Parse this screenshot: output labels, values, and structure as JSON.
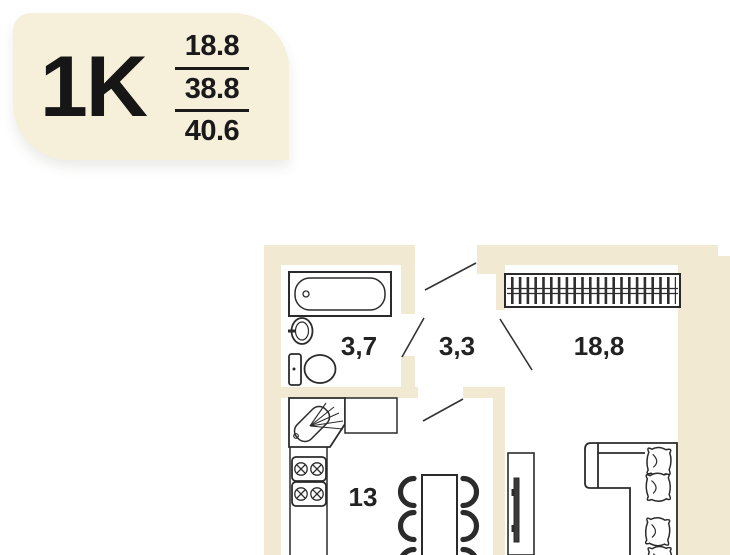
{
  "badge": {
    "type_label": "1K",
    "areas": {
      "living": "18.8",
      "apartment": "38.8",
      "total": "40.6"
    }
  },
  "floor_plan": {
    "room_labels": {
      "bathroom": "3,7",
      "hallway": "3,3",
      "living_room": "18,8",
      "kitchen": "13"
    },
    "fixture_names": [
      "bathtub",
      "wash-basin",
      "toilet",
      "corner-sink",
      "kitchen-counter",
      "stove",
      "wardrobe",
      "dining-table",
      "chair",
      "tv-stand",
      "corner-sofa",
      "sofa-pillow",
      "door-swing"
    ],
    "colors": {
      "wall": "#f1e9d2",
      "badge_bg": "#f6efda",
      "line": "#2b2b2b",
      "text": "#1f1f1f",
      "background": "#ffffff"
    }
  }
}
